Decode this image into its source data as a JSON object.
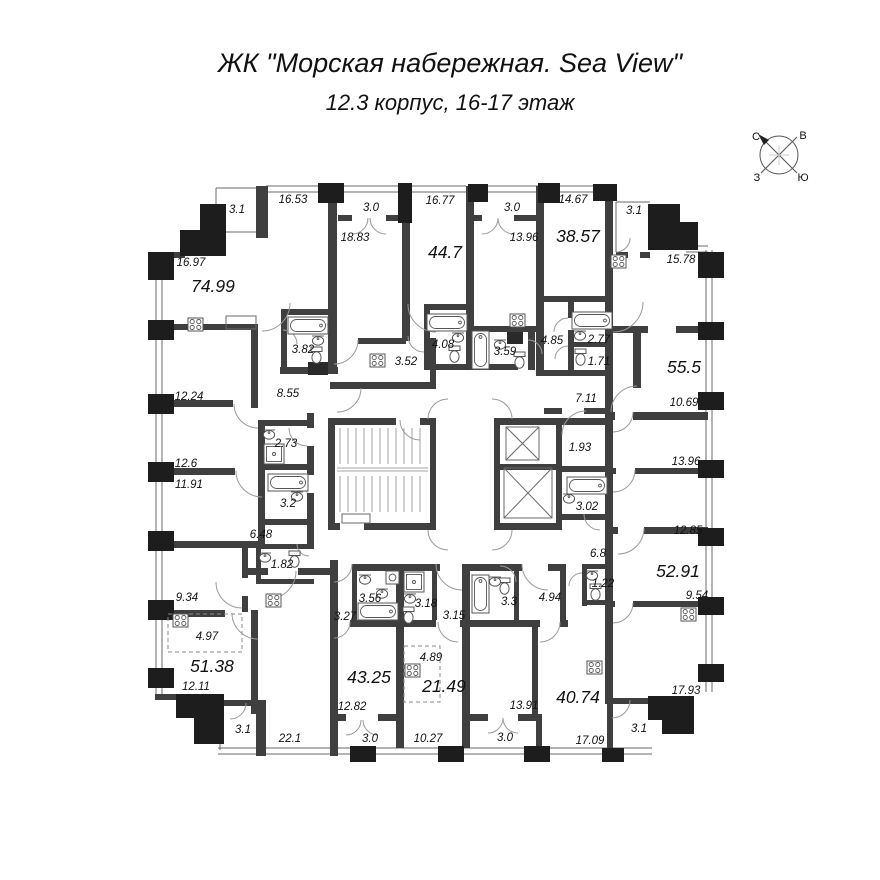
{
  "title": {
    "main": "ЖК \"Морская набережная. Sea View\"",
    "sub": "12.3 корпус, 16-17 этаж"
  },
  "compass": {
    "north": "С",
    "east": "В",
    "west": "З",
    "south": "Ю"
  },
  "colors": {
    "wall": "#3f3f3f",
    "pier": "#1d1d1d",
    "line": "#6a6a6a",
    "label": "#111111",
    "background": "#ffffff"
  },
  "areas": [
    "3.1",
    "16.53",
    "3.0",
    "16.77",
    "3.0",
    "13.96",
    "14.67",
    "3.1",
    "16.97",
    "74.99",
    "18.83",
    "44.7",
    "38.57",
    "15.78",
    "3.82",
    "3.52",
    "4.08",
    "3.59",
    "4.85",
    "2.77",
    "1.71",
    "55.5",
    "12.24",
    "8.55",
    "7.11",
    "10.69",
    "2.73",
    "12.6",
    "1.93",
    "13.96",
    "11.91",
    "3.2",
    "3.02",
    "12.85",
    "6.48",
    "6.8",
    "52.91",
    "1.82",
    "9.34",
    "1.22",
    "9.54",
    "3.56",
    "3.18",
    "3.27",
    "3.15",
    "3.3",
    "4.94",
    "4.97",
    "4.89",
    "51.38",
    "43.25",
    "21.49",
    "12.11",
    "17.93",
    "40.74",
    "12.82",
    "13.91",
    "3.1",
    "22.1",
    "3.0",
    "10.27",
    "3.0",
    "3.1",
    "17.09"
  ]
}
